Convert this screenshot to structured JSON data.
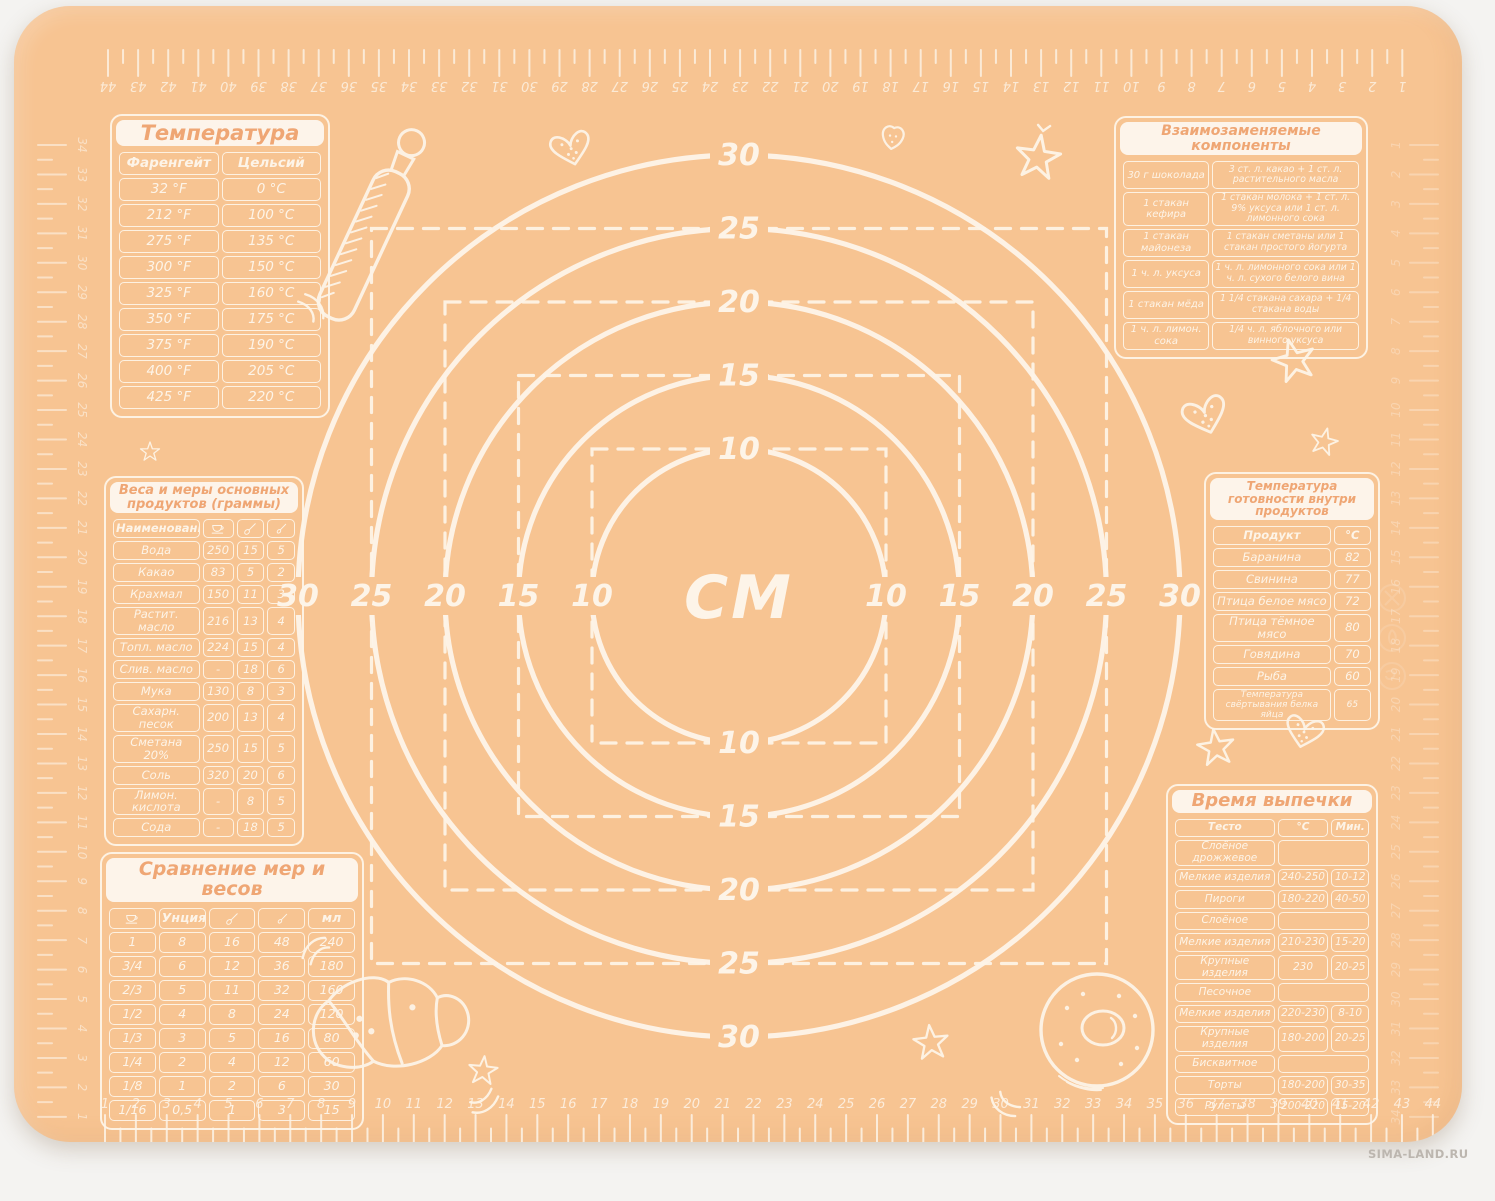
{
  "watermark": "SIMA-LAND.RU",
  "colors": {
    "mat": "#f7c492",
    "print": "#fdf4e8",
    "title_text": "#efa674",
    "page_bg": "#f4f3f1",
    "watermark_text": "#bcb6af"
  },
  "measuring_grid": {
    "center_label": "СМ",
    "circle_diameters_cm": [
      10,
      15,
      20,
      25,
      30
    ],
    "dashed_square_sides_cm": [
      10,
      15,
      20,
      25
    ]
  },
  "rulers": {
    "bottom": {
      "start": 1,
      "end": 44
    },
    "top": {
      "start": 44,
      "end": 1
    },
    "left": {
      "start": 34,
      "end": 1
    },
    "right": {
      "start": 1,
      "end": 34
    }
  },
  "tables": {
    "temperature": {
      "title": "Температура",
      "col_headers": [
        "Фаренгейт",
        "Цельсий"
      ],
      "rows": [
        [
          "32 °F",
          "0 °C"
        ],
        [
          "212 °F",
          "100 °C"
        ],
        [
          "275 °F",
          "135 °C"
        ],
        [
          "300 °F",
          "150 °C"
        ],
        [
          "325 °F",
          "160 °C"
        ],
        [
          "350 °F",
          "175 °C"
        ],
        [
          "375 °F",
          "190 °C"
        ],
        [
          "400 °F",
          "205 °C"
        ],
        [
          "425 °F",
          "220 °C"
        ]
      ]
    },
    "components": {
      "title": "Взаимозаменяемые компоненты",
      "rows": [
        [
          "30 г шоколада",
          "3 ст. л. какао + 1 ст. л. растительного масла"
        ],
        [
          "1 стакан кефира",
          "1 стакан молока + 1 ст. л. 9% уксуса или 1 ст. л. лимонного сока"
        ],
        [
          "1 стакан майонеза",
          "1 стакан сметаны или 1 стакан простого йогурта"
        ],
        [
          "1 ч. л. уксуса",
          "1 ч. л. лимонного сока или 1 ч. л. сухого белого вина"
        ],
        [
          "1 стакан мёда",
          "1 1/4 стакана сахара + 1/4 стакана воды"
        ],
        [
          "1 ч. л. лимон. сока",
          "1/4 ч. л. яблочного или винного уксуса"
        ]
      ]
    },
    "weights": {
      "title": "Веса и меры основных продуктов (граммы)",
      "col_headers": [
        "Наименование",
        {
          "icon": "cup-icon"
        },
        {
          "icon": "tablespoon-icon"
        },
        {
          "icon": "teaspoon-icon"
        }
      ],
      "rows": [
        [
          "Вода",
          "250",
          "15",
          "5"
        ],
        [
          "Какао",
          "83",
          "5",
          "2"
        ],
        [
          "Крахмал",
          "150",
          "11",
          "3"
        ],
        [
          "Растит. масло",
          "216",
          "13",
          "4"
        ],
        [
          "Топл. масло",
          "224",
          "15",
          "4"
        ],
        [
          "Слив. масло",
          "-",
          "18",
          "6"
        ],
        [
          "Мука",
          "130",
          "8",
          "3"
        ],
        [
          "Сахарн. песок",
          "200",
          "13",
          "4"
        ],
        [
          "Сметана 20%",
          "250",
          "15",
          "5"
        ],
        [
          "Соль",
          "320",
          "20",
          "6"
        ],
        [
          "Лимон. кислота",
          "-",
          "8",
          "5"
        ],
        [
          "Сода",
          "-",
          "18",
          "5"
        ]
      ]
    },
    "readiness": {
      "title": "Температура готовности внутри продуктов",
      "col_headers": [
        "Продукт",
        "°С"
      ],
      "rows": [
        [
          "Баранина",
          "82"
        ],
        [
          "Свинина",
          "77"
        ],
        [
          "Птица белое мясо",
          "72"
        ],
        [
          "Птица тёмное мясо",
          "80"
        ],
        [
          "Говядина",
          "70"
        ],
        [
          "Рыба",
          "60"
        ],
        [
          "Температура свёртывания белка яйца",
          "65"
        ]
      ]
    },
    "comparison": {
      "title": "Сравнение мер и весов",
      "col_headers": [
        {
          "icon": "cup-icon"
        },
        "Унция",
        {
          "icon": "tablespoon-icon"
        },
        {
          "icon": "teaspoon-icon"
        },
        "мл"
      ],
      "rows": [
        [
          "1",
          "8",
          "16",
          "48",
          "240"
        ],
        [
          "3/4",
          "6",
          "12",
          "36",
          "180"
        ],
        [
          "2/3",
          "5",
          "11",
          "32",
          "160"
        ],
        [
          "1/2",
          "4",
          "8",
          "24",
          "120"
        ],
        [
          "1/3",
          "3",
          "5",
          "16",
          "80"
        ],
        [
          "1/4",
          "2",
          "4",
          "12",
          "60"
        ],
        [
          "1/8",
          "1",
          "2",
          "6",
          "30"
        ],
        [
          "1/16",
          "0,5",
          "1",
          "3",
          "15"
        ]
      ]
    },
    "baking": {
      "title": "Время выпечки",
      "col_headers": [
        "Тесто",
        "°С",
        "Мин."
      ],
      "rows": [
        [
          "Слоёное дрожжевое",
          "",
          ""
        ],
        [
          "Мелкие изделия",
          "240-250",
          "10-12"
        ],
        [
          "Пироги",
          "180-220",
          "40-50"
        ],
        [
          "Слоёное",
          "",
          ""
        ],
        [
          "Мелкие изделия",
          "210-230",
          "15-20"
        ],
        [
          "Крупные изделия",
          "230",
          "20-25"
        ],
        [
          "Песочное",
          "",
          ""
        ],
        [
          "Мелкие изделия",
          "220-230",
          "8-10"
        ],
        [
          "Крупные изделия",
          "180-200",
          "20-25"
        ],
        [
          "Бисквитное",
          "",
          ""
        ],
        [
          "Торты",
          "180-200",
          "30-35"
        ],
        [
          "Рулеты",
          "200-220",
          "15-20"
        ]
      ]
    }
  },
  "decorations": [
    {
      "name": "rolling-pin-icon",
      "x": 354,
      "y": 230,
      "s": 1,
      "r": 25
    },
    {
      "name": "accent-arc-icon",
      "x": 296,
      "y": 302,
      "s": 1,
      "r": 55
    },
    {
      "name": "dotted-heart-icon",
      "x": 554,
      "y": 130,
      "s": 1,
      "r": -14
    },
    {
      "name": "berry-icon",
      "x": 879,
      "y": 130,
      "s": 1,
      "r": 8
    },
    {
      "name": "chevron-icon",
      "x": 1030,
      "y": 120,
      "s": 1,
      "r": 10
    },
    {
      "name": "star-icon",
      "x": 1024,
      "y": 152,
      "s": 1.15,
      "r": 8
    },
    {
      "name": "star-icon",
      "x": 1280,
      "y": 355,
      "s": 1.1,
      "r": -15
    },
    {
      "name": "dotted-heart-icon",
      "x": 1187,
      "y": 396,
      "s": 1.1,
      "r": -18
    },
    {
      "name": "star-icon",
      "x": 1310,
      "y": 436,
      "s": 0.7,
      "r": 14
    },
    {
      "name": "dotted-heart-icon",
      "x": 1293,
      "y": 714,
      "s": 0.95,
      "r": 14
    },
    {
      "name": "star-icon",
      "x": 1202,
      "y": 742,
      "s": 0.95,
      "r": -8
    },
    {
      "name": "star-icon",
      "x": 136,
      "y": 446,
      "s": 0.5,
      "r": 0
    },
    {
      "name": "croissant-icon",
      "x": 380,
      "y": 1014,
      "s": 1,
      "r": -8
    },
    {
      "name": "accent-arc-icon",
      "x": 302,
      "y": 946,
      "s": 1,
      "r": -40
    },
    {
      "name": "accent-arc-icon",
      "x": 470,
      "y": 1094,
      "s": 1,
      "r": 150
    },
    {
      "name": "star-icon",
      "x": 469,
      "y": 1065,
      "s": 0.75,
      "r": 6
    },
    {
      "name": "star-icon",
      "x": 917,
      "y": 1037,
      "s": 0.9,
      "r": -6
    },
    {
      "name": "donut-icon",
      "x": 1083,
      "y": 1024,
      "s": 1,
      "r": 0
    },
    {
      "name": "accent-arc-icon",
      "x": 993,
      "y": 1098,
      "s": 1,
      "r": -140
    }
  ]
}
